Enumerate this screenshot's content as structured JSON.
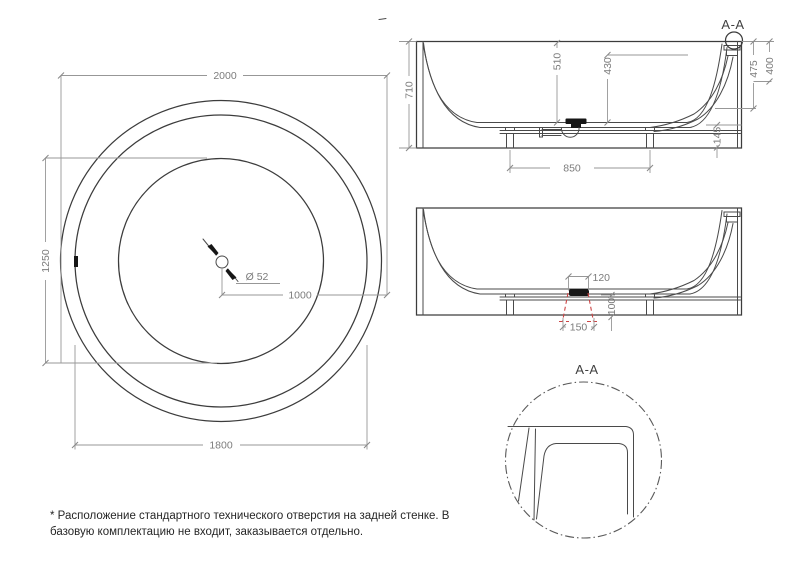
{
  "colors": {
    "object_line": "#3c3c3c",
    "dimension_line": "#979797",
    "dimension_text": "#7c7c7c",
    "red_dashed": "#cc4444",
    "background": "#ffffff"
  },
  "top_view": {
    "dim_outer_diameter": "2000",
    "dim_rim_diameter": "1800",
    "dim_bowl_diameter": "1250",
    "dim_center_to_edge": "1000",
    "drain_diameter_label": "Ø 52"
  },
  "section_view": {
    "section_label": "A-A",
    "dim_total_height": "710",
    "dim_inner_depth": "510",
    "dim_water_depth": "430",
    "dim_overflow_height_a": "475",
    "dim_overflow_height_b": "400",
    "dim_bottom_clearance": "145",
    "dim_feet_span": "850"
  },
  "hole_view": {
    "dim_hole_top_width": "120",
    "dim_hole_bottom_width": "150",
    "dim_hole_height": "100"
  },
  "detail_view": {
    "detail_label": "A-A"
  },
  "note": {
    "line1": "* Расположение стандартного технического отверстия на задней стенке. В",
    "line2": "базовую комплектацию не входит, заказывается отдельно."
  }
}
